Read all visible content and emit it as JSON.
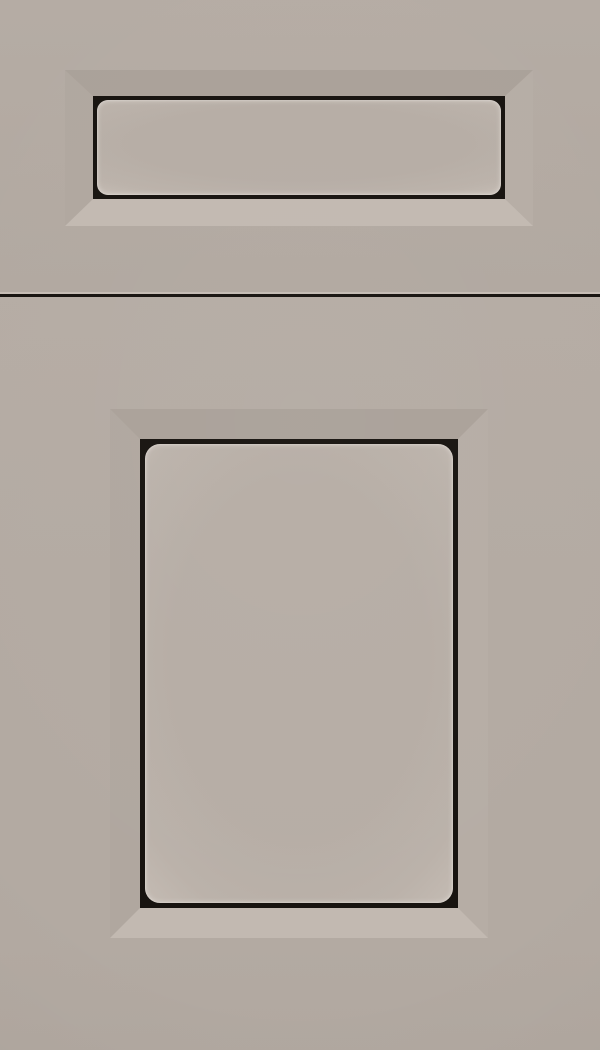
{
  "image": {
    "kind": "product-photo",
    "subject": "painted cabinet drawer front and door sample",
    "finish_style": "greige paint with dark glaze outline, beveled frame, recessed flat panels"
  },
  "parts": {
    "drawer_front": "drawer front with recessed beveled rectangular panel",
    "gap": "horizontal shadow gap between drawer front and door",
    "door": "cabinet door with recessed beveled rectangular panel"
  },
  "colors": {
    "base": "#b3aaa2",
    "base_top": "#b5aca4",
    "base_bottom": "#b1a8a0",
    "panel": "#b6ada5",
    "panel_mid": "#bbb2aa",
    "panel_edge": "#c3bab2",
    "bevel_top": "#aaa199",
    "bevel_left": "#b0a79f",
    "bevel_right": "#b6ada5",
    "bevel_bottom": "#c2b9b1",
    "glaze_outline": "#17130f",
    "gap_highlight": "#c5bcb4",
    "gap_line": "#17130f"
  }
}
